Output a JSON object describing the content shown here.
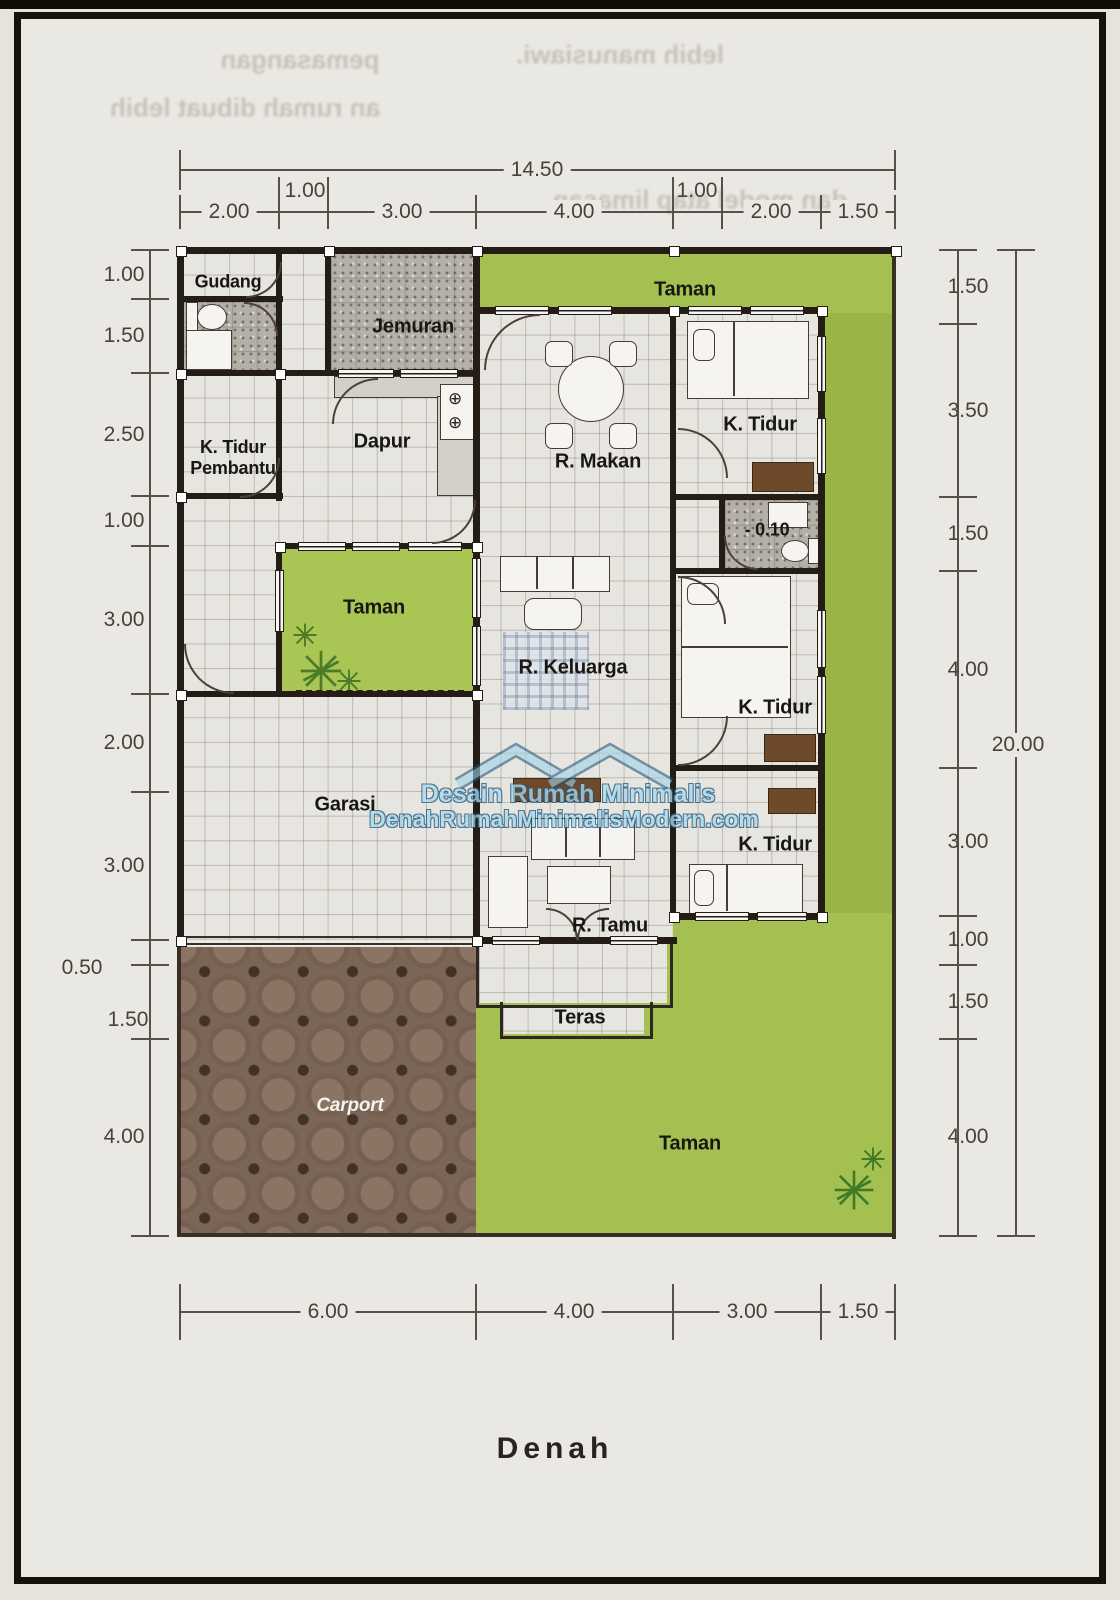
{
  "page": {
    "title": "Denah"
  },
  "plan": {
    "rooms": {
      "gudang": "Gudang",
      "jemuran": "Jemuran",
      "k_tidur_pembantu": "K. Tidur\nPembantu",
      "dapur": "Dapur",
      "r_makan": "R. Makan",
      "taman_top": "Taman",
      "k_tidur_1": "K. Tidur",
      "bath_level": "- 0.10",
      "taman_inner": "Taman",
      "r_keluarga": "R. Keluarga",
      "k_tidur_2": "K. Tidur",
      "garasi": "Garasi",
      "k_tidur_3": "K. Tidur",
      "r_tamu": "R. Tamu",
      "teras": "Teras",
      "carport": "Carport",
      "taman_bottom": "Taman"
    }
  },
  "dims": {
    "top_total": "14.50",
    "top": [
      "2.00",
      "1.00",
      "3.00",
      "4.00",
      "1.00",
      "2.00",
      "1.50"
    ],
    "left": [
      "1.00",
      "1.50",
      "2.50",
      "1.00",
      "3.00",
      "2.00",
      "3.00",
      "0.50",
      "1.50",
      "4.00"
    ],
    "right": [
      "1.50",
      "3.50",
      "1.50",
      "4.00",
      "3.00",
      "1.00",
      "1.50",
      "4.00"
    ],
    "right_total": "20.00",
    "bottom": [
      "6.00",
      "4.00",
      "3.00",
      "1.50"
    ]
  },
  "watermark": {
    "brand": "Desain Rumah Minimalis",
    "site": "DenahRumahMinimalisModern.com"
  },
  "icons": {
    "burner": "⊕"
  },
  "ghost_text": [
    "pemasangan",
    "lebih manusiawi.",
    "an rumah dibuat lebih",
    "dan model atap limasan"
  ],
  "colors": {
    "garden_green": "#a4c050",
    "wall_black": "#241d16",
    "carport_brown": "#7a6557",
    "watermark_blue": "#a9d9ec"
  }
}
